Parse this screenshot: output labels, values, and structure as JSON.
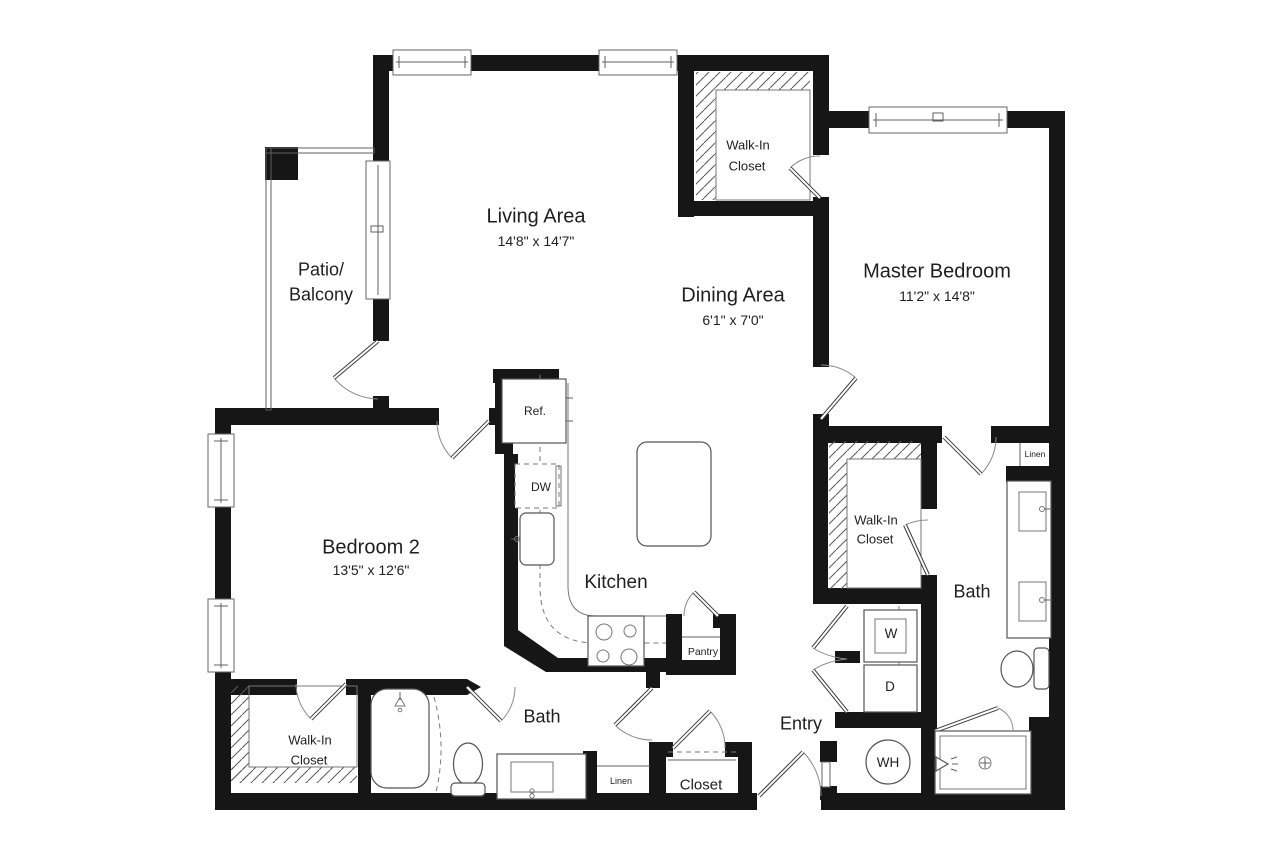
{
  "floor_plan": {
    "rooms": {
      "living": {
        "name": "Living Area",
        "dims": "14'8\" x 14'7\""
      },
      "dining": {
        "name": "Dining Area",
        "dims": "6'1\" x 7'0\""
      },
      "master": {
        "name": "Master Bedroom",
        "dims": "11'2\" x 14'8\""
      },
      "bedroom2": {
        "name": "Bedroom 2",
        "dims": "13'5\" x 12'6\""
      },
      "kitchen": {
        "name": "Kitchen"
      },
      "patio": {
        "line1": "Patio/",
        "line2": "Balcony"
      },
      "entry": {
        "name": "Entry"
      },
      "bath_master": {
        "name": "Bath"
      },
      "bath_hall": {
        "name": "Bath"
      }
    },
    "closets": {
      "walkin_top": {
        "line1": "Walk-In",
        "line2": "Closet"
      },
      "walkin_master": {
        "line1": "Walk-In",
        "line2": "Closet"
      },
      "walkin_bedroom2": {
        "line1": "Walk-In",
        "line2": "Closet"
      },
      "entry_closet": {
        "name": "Closet"
      },
      "pantry": {
        "name": "Pantry"
      },
      "linen_bath": {
        "name": "Linen"
      },
      "linen_master": {
        "name": "Linen"
      }
    },
    "appliances": {
      "refrigerator": "Ref.",
      "dishwasher": "DW",
      "washer": "W",
      "dryer": "D",
      "water_heater": "WH"
    },
    "colors": {
      "wall": "#161616",
      "line": "#606060",
      "text": "#1f1f1f",
      "background": "#ffffff"
    }
  }
}
